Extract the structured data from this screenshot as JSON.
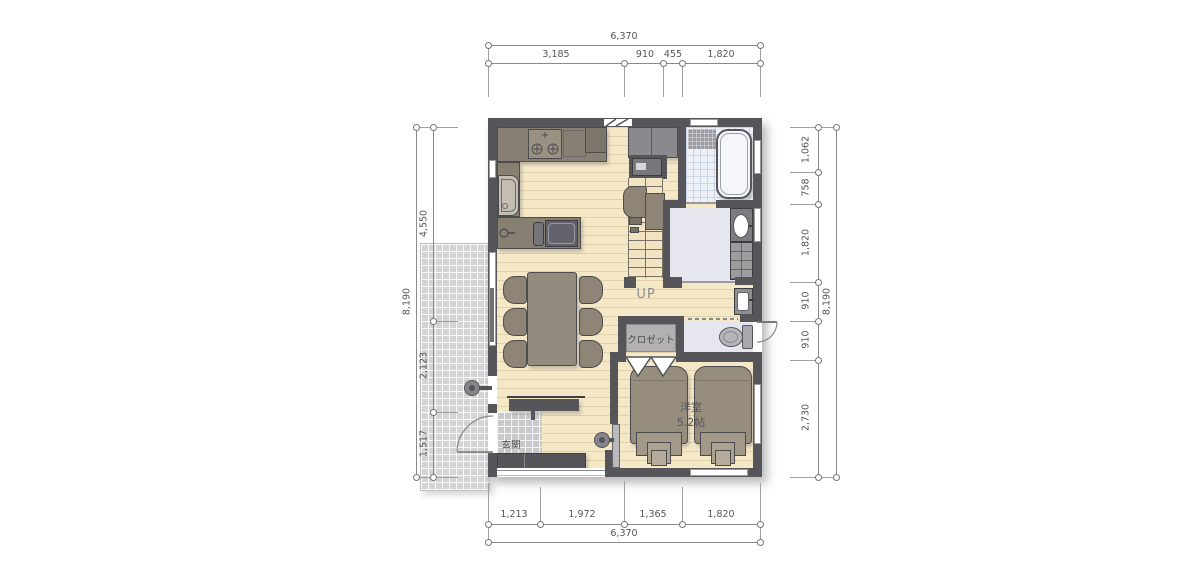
{
  "dimensions": {
    "top": {
      "total": "6,370",
      "segments": [
        "3,185",
        "910",
        "455",
        "1,820"
      ]
    },
    "bottom": {
      "total": "6,370",
      "segments": [
        "1,213",
        "1,972",
        "1,365",
        "1,820"
      ]
    },
    "left": {
      "total": "8,190",
      "segments": [
        "4,550",
        "2,123",
        "1,517"
      ]
    },
    "right": {
      "total": "8,190",
      "segments": [
        "1,062",
        "758",
        "1,820",
        "910",
        "910",
        "2,730"
      ]
    }
  },
  "labels": {
    "stairs": "UP",
    "closet": "クロゼット",
    "bedroom_name": "洋室",
    "bedroom_size": "5.2帖",
    "entrance": "玄関"
  },
  "colors": {
    "wall": "#55555a",
    "wood_floor": "#f5e8c6",
    "terrace_tile": "#d4d4d6",
    "wet_room_floor": "#e6e6ee",
    "bath_tile": "#eef1f7",
    "furniture": "#8e8577",
    "dimension_text": "#555555"
  }
}
